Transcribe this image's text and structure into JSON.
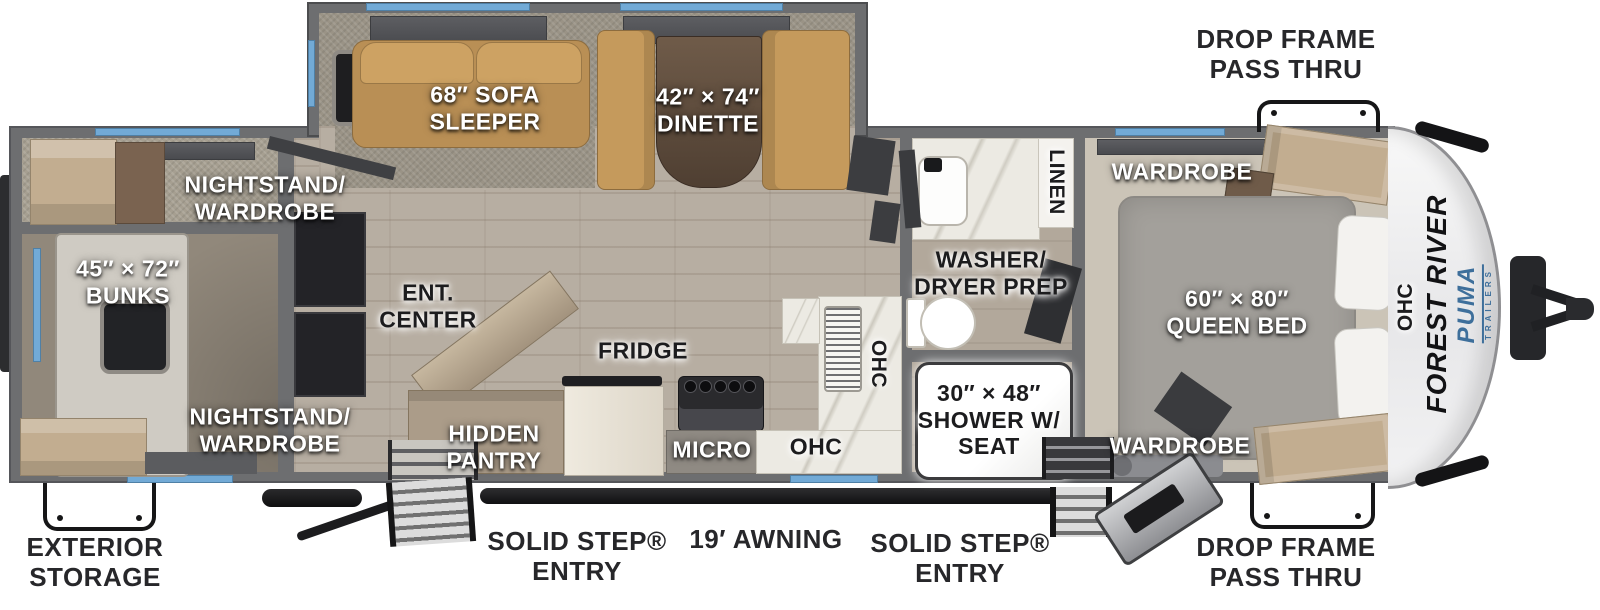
{
  "title": "Forest River Puma travel trailer floor plan",
  "brand": {
    "name": "FOREST RIVER",
    "model": "PUMA",
    "model_tagline": "TRAILERS"
  },
  "labels": {
    "drop_frame_top": "DROP FRAME\nPASS THRU",
    "drop_frame_bottom": "DROP FRAME\nPASS THRU",
    "exterior_storage": "EXTERIOR\nSTORAGE",
    "solid_step_left": "SOLID STEP®\nENTRY",
    "solid_step_right": "SOLID STEP®\nENTRY",
    "awning": "19′ AWNING",
    "bunks": "45″ × 72″\nBUNKS",
    "nightstand_top": "NIGHTSTAND/\nWARDROBE",
    "nightstand_bottom": "NIGHTSTAND/\nWARDROBE",
    "sofa": "68″ SOFA\nSLEEPER",
    "dinette": "42″ × 74″\nDINETTE",
    "ent_center": "ENT.\nCENTER",
    "hidden_pantry": "HIDDEN\nPANTRY",
    "fridge": "FRIDGE",
    "micro": "MICRO",
    "ohc_kitchen_upper": "OHC",
    "ohc_kitchen_lower": "OHC",
    "washer_dryer": "WASHER/\nDRYER PREP",
    "linen": "LINEN",
    "shower": "30″ × 48″\nSHOWER W/\nSEAT",
    "wardrobe_top": "WARDROBE",
    "wardrobe_bottom": "WARDROBE",
    "queen_bed": "60″ × 80″\nQUEEN BED",
    "ohc_bedroom": "OHC"
  },
  "colors": {
    "window_blue": "#72aad6",
    "wall_gray": "#6d6e70",
    "furniture_tan": "#c59a5c",
    "cabinet_tan": "#c2ad90",
    "brand_blue": "#3e6f9b"
  }
}
